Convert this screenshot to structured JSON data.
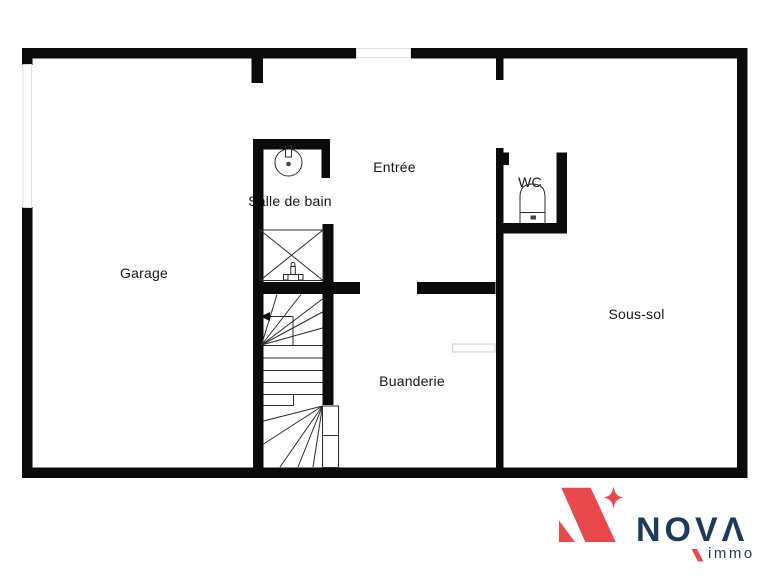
{
  "page": {
    "background": "#ffffff"
  },
  "floor_plan": {
    "type": "basement-floor-plan",
    "rooms": [
      {
        "id": "garage",
        "label": "Garage"
      },
      {
        "id": "salle-de-bain",
        "label": "Salle de bain"
      },
      {
        "id": "entree",
        "label": "Entrée"
      },
      {
        "id": "wc",
        "label": "WC"
      },
      {
        "id": "sous-sol",
        "label": "Sous-sol"
      },
      {
        "id": "buanderie",
        "label": "Buanderie"
      }
    ],
    "fixtures": [
      {
        "icon": "sink-icon",
        "room": "salle-de-bain"
      },
      {
        "icon": "shower-icon",
        "room": "salle-de-bain"
      },
      {
        "icon": "toilet-icon",
        "room": "wc"
      },
      {
        "icon": "staircase-icon",
        "room": "buanderie"
      },
      {
        "icon": "closet-icon",
        "room": "buanderie"
      }
    ],
    "colors": {
      "wall": "#0b0b0b",
      "line": "#2b2b2b",
      "window": "#dfdfdf",
      "label": "#161616"
    }
  },
  "logo": {
    "brand": "NOVA",
    "brand_display": "NOVΛ",
    "tagline": "immo",
    "colors": {
      "red": "#e9494d",
      "navy": "#1e3a5b"
    }
  }
}
